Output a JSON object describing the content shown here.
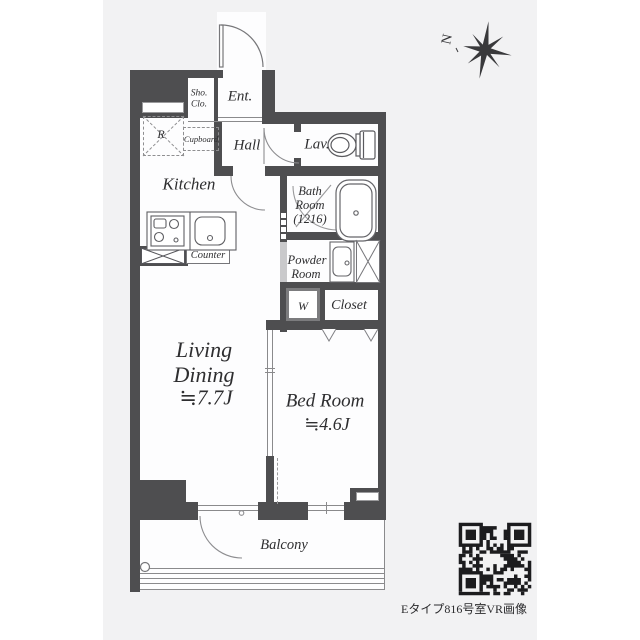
{
  "colors": {
    "page_background": "#ffffff",
    "panel_background": "#f2f2f3",
    "wall": "#4e4e50",
    "thin_line": "#8a8a8c",
    "text": "#2e2e30"
  },
  "compass": {
    "label": "N"
  },
  "rooms": {
    "shoe_closet": {
      "lines": [
        "Sho.",
        "Clo."
      ]
    },
    "entrance": {
      "label": "Ent."
    },
    "hall": {
      "label": "Hall"
    },
    "lavatory": {
      "label": "Lav."
    },
    "bathroom": {
      "lines": [
        "Bath",
        "Room",
        "(1216)"
      ]
    },
    "powder_room": {
      "lines": [
        "Powder",
        "Room"
      ]
    },
    "washer": {
      "label": "W"
    },
    "closet": {
      "label": "Closet"
    },
    "kitchen": {
      "label": "Kitchen"
    },
    "refrigerator": {
      "label": "R"
    },
    "cupboard": {
      "label": "Cupboard"
    },
    "counter": {
      "label": "Counter"
    },
    "living_dining": {
      "lines": [
        "Living",
        "Dining",
        "≒7.7J"
      ]
    },
    "bedroom": {
      "lines": [
        "Bed Room",
        "≒4.6J"
      ]
    },
    "balcony": {
      "label": "Balcony"
    }
  },
  "footer": {
    "qr_caption": "Eタイプ816号室VR画像"
  }
}
